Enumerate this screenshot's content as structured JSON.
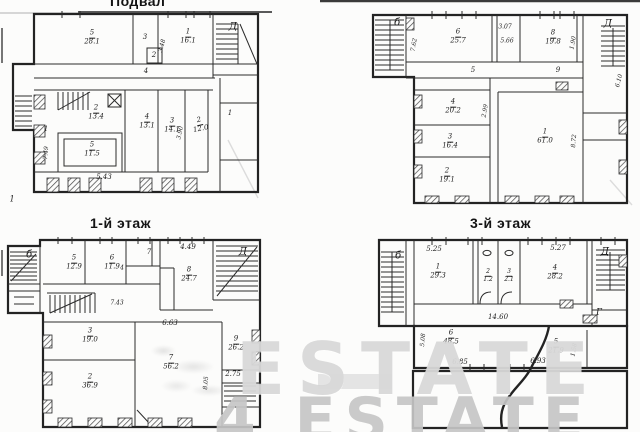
{
  "page": {
    "background": "#fcfcfb",
    "ink": "#232323",
    "watermark_top": "ESTATE",
    "watermark_bottom": "4 ESTATE",
    "watermark_top_color": "#d5d5d5",
    "watermark_bottom_color": "#c6c6c6"
  },
  "plans": {
    "basement": {
      "title": "Подвал",
      "labels": [
        {
          "x": 92,
          "y": 38,
          "num": "5",
          "area": "28.1"
        },
        {
          "x": 145,
          "y": 38,
          "text": "3"
        },
        {
          "x": 188,
          "y": 37,
          "num": "1",
          "area": "16.1"
        },
        {
          "x": 233,
          "y": 27,
          "text": "Д",
          "s": 10
        },
        {
          "x": 163,
          "y": 46,
          "text": "3.48",
          "r": -75,
          "s": 6
        },
        {
          "x": 154,
          "y": 56,
          "text": "2",
          "s": 7
        },
        {
          "x": 146,
          "y": 72,
          "text": "4"
        },
        {
          "x": 96,
          "y": 113,
          "num": "2",
          "area": "13.4"
        },
        {
          "x": 147,
          "y": 122,
          "num": "4",
          "area": "13.1"
        },
        {
          "x": 172,
          "y": 126,
          "num": "3",
          "area": "14.1"
        },
        {
          "x": 181,
          "y": 133,
          "text": "3.90",
          "r": -78,
          "s": 6
        },
        {
          "x": 200,
          "y": 125,
          "num": "2",
          "area": "12.0",
          "r": -12
        },
        {
          "x": 230,
          "y": 114,
          "text": "1"
        },
        {
          "x": 46,
          "y": 130,
          "text": "1"
        },
        {
          "x": 92,
          "y": 150,
          "num": "5",
          "area": "11.5"
        },
        {
          "x": 47,
          "y": 153,
          "text": "7.49",
          "r": -85,
          "s": 6
        },
        {
          "x": 104,
          "y": 178,
          "text": "5.43"
        },
        {
          "x": 12,
          "y": 200,
          "text": "1",
          "s": 8
        }
      ]
    },
    "floor2": {
      "labels": [
        {
          "x": 397,
          "y": 23,
          "text": "б",
          "s": 10
        },
        {
          "x": 415,
          "y": 45,
          "text": "7.62",
          "r": -80,
          "s": 6
        },
        {
          "x": 458,
          "y": 37,
          "num": "6",
          "area": "25.7"
        },
        {
          "x": 505,
          "y": 28,
          "text": "3.07",
          "s": 6
        },
        {
          "x": 507,
          "y": 42,
          "text": "5.66",
          "s": 6
        },
        {
          "x": 553,
          "y": 38,
          "num": "8",
          "area": "19.8"
        },
        {
          "x": 574,
          "y": 43,
          "text": "1.90",
          "r": -80,
          "s": 6
        },
        {
          "x": 608,
          "y": 24,
          "text": "Д",
          "s": 10
        },
        {
          "x": 473,
          "y": 71,
          "text": "5"
        },
        {
          "x": 558,
          "y": 71,
          "text": "9"
        },
        {
          "x": 620,
          "y": 81,
          "text": "6.10",
          "r": -75,
          "s": 6
        },
        {
          "x": 453,
          "y": 107,
          "num": "4",
          "area": "20.2"
        },
        {
          "x": 486,
          "y": 111,
          "text": "2.99",
          "r": -80,
          "s": 6
        },
        {
          "x": 450,
          "y": 142,
          "num": "3",
          "area": "16.4"
        },
        {
          "x": 447,
          "y": 176,
          "num": "2",
          "area": "19.1"
        },
        {
          "x": 545,
          "y": 137,
          "num": "1",
          "area": "61.0"
        },
        {
          "x": 575,
          "y": 141,
          "text": "8.72",
          "r": -85,
          "s": 6
        }
      ]
    },
    "floor1": {
      "title": "1-й этаж",
      "labels": [
        {
          "x": 29,
          "y": 255,
          "text": "б",
          "s": 10
        },
        {
          "x": 74,
          "y": 263,
          "num": "5",
          "area": "12.9"
        },
        {
          "x": 112,
          "y": 263,
          "num": "6",
          "area": "11.9"
        },
        {
          "x": 122,
          "y": 269,
          "text": "4",
          "s": 6
        },
        {
          "x": 149,
          "y": 253,
          "text": "7"
        },
        {
          "x": 188,
          "y": 248,
          "text": "4.49"
        },
        {
          "x": 189,
          "y": 275,
          "num": "8",
          "area": "24.7"
        },
        {
          "x": 243,
          "y": 252,
          "text": "Д",
          "s": 10
        },
        {
          "x": 117,
          "y": 304,
          "text": "7.43",
          "s": 6
        },
        {
          "x": 90,
          "y": 336,
          "num": "3",
          "area": "19.0"
        },
        {
          "x": 170,
          "y": 324,
          "text": "6.63"
        },
        {
          "x": 171,
          "y": 363,
          "num": "7",
          "area": "56.2"
        },
        {
          "x": 236,
          "y": 344,
          "num": "9",
          "area": "26.2"
        },
        {
          "x": 233,
          "y": 375,
          "text": "2.75"
        },
        {
          "x": 207,
          "y": 383,
          "text": "8.05",
          "r": -85,
          "s": 6
        },
        {
          "x": 90,
          "y": 382,
          "num": "2",
          "area": "36.9"
        }
      ]
    },
    "floor3": {
      "title": "3-й этаж",
      "labels": [
        {
          "x": 398,
          "y": 256,
          "text": "б",
          "s": 10
        },
        {
          "x": 434,
          "y": 250,
          "text": "5.25"
        },
        {
          "x": 438,
          "y": 272,
          "num": "1",
          "area": "29.3"
        },
        {
          "x": 488,
          "y": 276,
          "num": "2",
          "area": "1.2",
          "s": 6
        },
        {
          "x": 509,
          "y": 276,
          "num": "3",
          "area": "2.1",
          "s": 6
        },
        {
          "x": 558,
          "y": 249,
          "text": "5.27"
        },
        {
          "x": 555,
          "y": 273,
          "num": "4",
          "area": "28.2"
        },
        {
          "x": 605,
          "y": 252,
          "text": "Д",
          "s": 10
        },
        {
          "x": 599,
          "y": 313,
          "text": "Г",
          "s": 9
        },
        {
          "x": 498,
          "y": 318,
          "text": "14.60"
        },
        {
          "x": 424,
          "y": 340,
          "text": "5.08",
          "r": -85,
          "s": 6
        },
        {
          "x": 451,
          "y": 338,
          "num": "6",
          "area": "48.5"
        },
        {
          "x": 556,
          "y": 347,
          "num": "5",
          "area": "21.9"
        },
        {
          "x": 575,
          "y": 350,
          "text": "1.58",
          "r": -80,
          "s": 6
        },
        {
          "x": 460,
          "y": 363,
          "text": "6.85"
        },
        {
          "x": 538,
          "y": 362,
          "text": "6.93"
        }
      ]
    }
  }
}
